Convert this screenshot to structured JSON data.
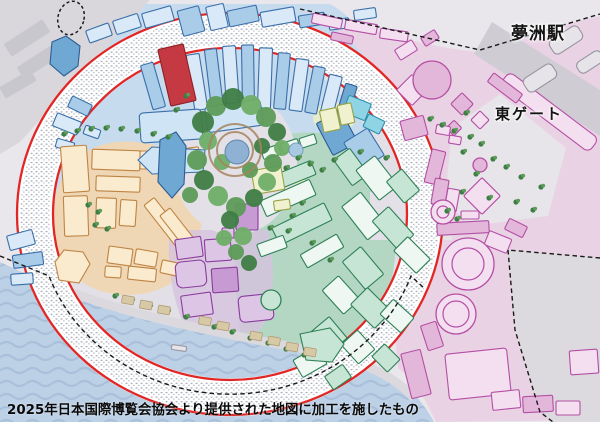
{
  "map": {
    "labels": {
      "station": "夢洲駅",
      "east_gate": "東ゲート"
    },
    "caption": "2025年日本国際博覧会協会より提供された地図に加工を施したもの",
    "colors": {
      "water": "#bcd0e6",
      "wave_lines": "#a6bdd9",
      "land_base": "#e6e4e9",
      "outside_gray": "#d9d7dc",
      "ring_fill": "#ffffff",
      "ring_red": "#e02725",
      "zone_blue": "#c6dbee",
      "zone_orange": "#efd7b5",
      "zone_green": "#b4d7c4",
      "zone_purple": "#d6c3de",
      "zone_yellow_green": "#e9ecc8",
      "zone_pink": "#ead2e5",
      "highlight_red_building": "#c53a42",
      "forest_green": "#4c8b4f",
      "pond_blue": "#8fb2d4",
      "boundary_dash": "#1a1a1a"
    }
  }
}
